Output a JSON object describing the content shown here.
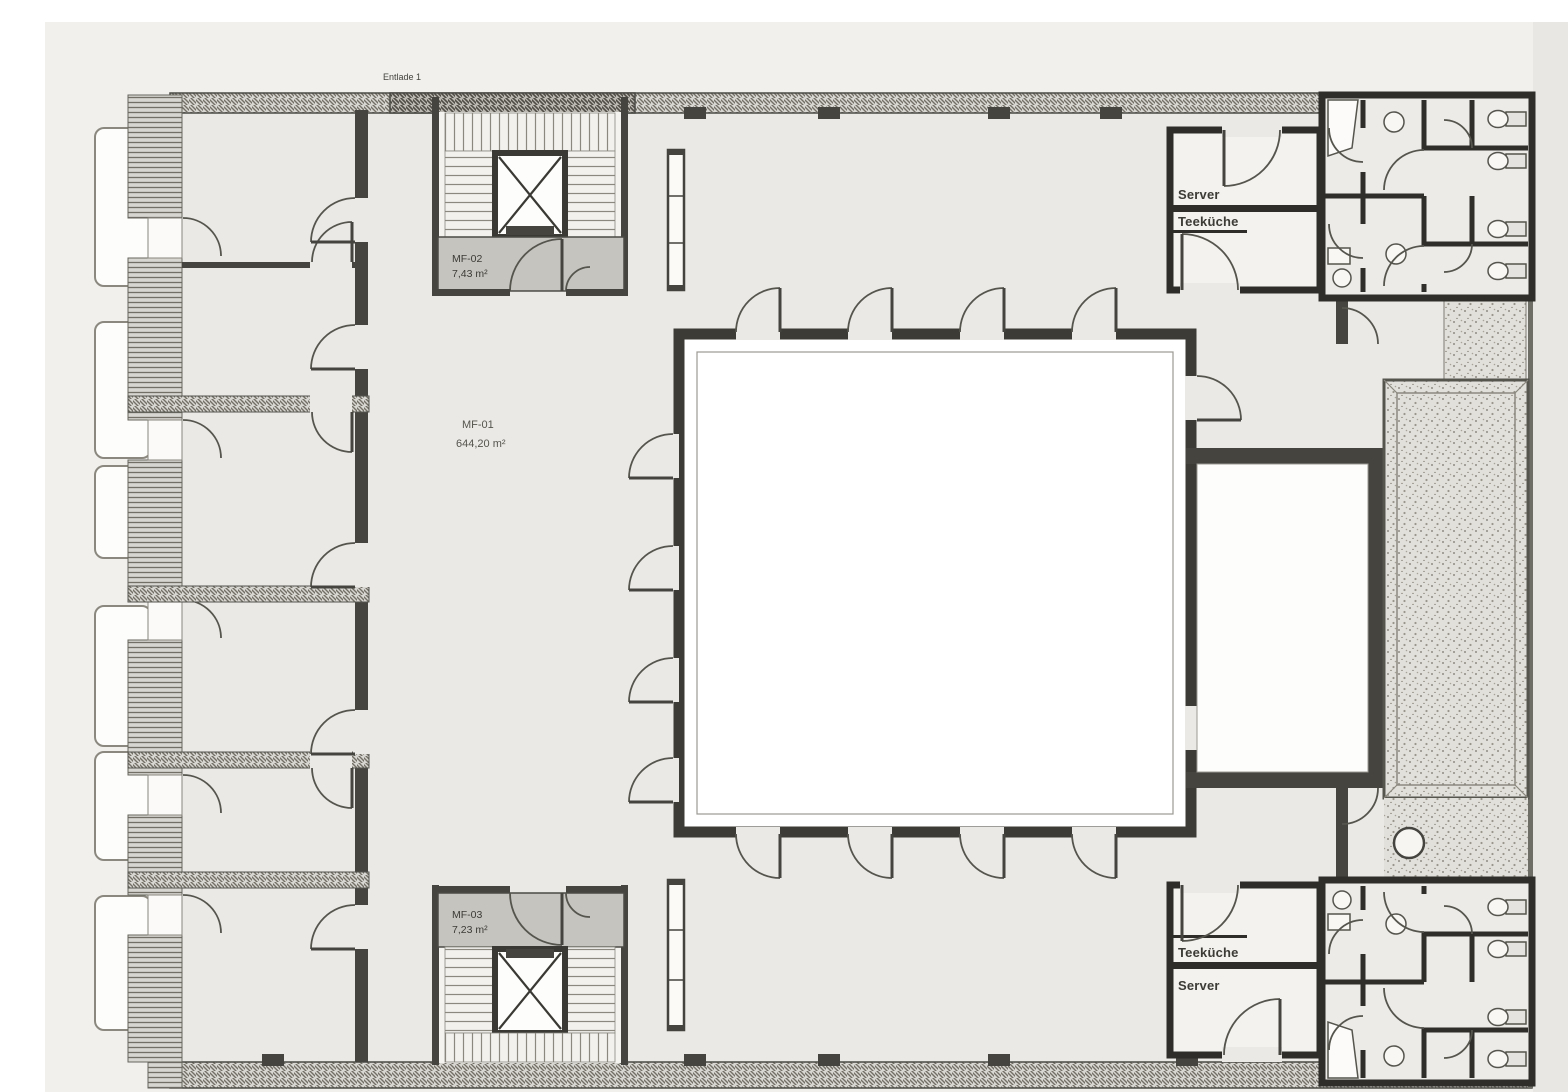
{
  "labels": {
    "section_marker": "Entlade 1",
    "area_main": {
      "code": "MF-01",
      "size": "644,20 m²"
    },
    "stair_top": {
      "code": "MF-02",
      "size": "7,43 m²"
    },
    "stair_bottom": {
      "code": "MF-03",
      "size": "7,23 m²"
    },
    "block_top_right": {
      "top": "Server",
      "bottom": "Teeküche"
    },
    "block_bottom_right": {
      "top": "Teeküche",
      "bottom": "Server"
    }
  },
  "colors": {
    "paper": "#f1f0ed",
    "paper_right": "#e9e7e4",
    "floor": "#ebe9e5",
    "wall": "#45443e",
    "room": "#fdfdfb",
    "vestibule": "#c6c4bf",
    "line": "#55544d",
    "hatch_bg": "#d8d6d0",
    "stipple_bg": "#e2e0da",
    "text": "#3c3b35"
  }
}
